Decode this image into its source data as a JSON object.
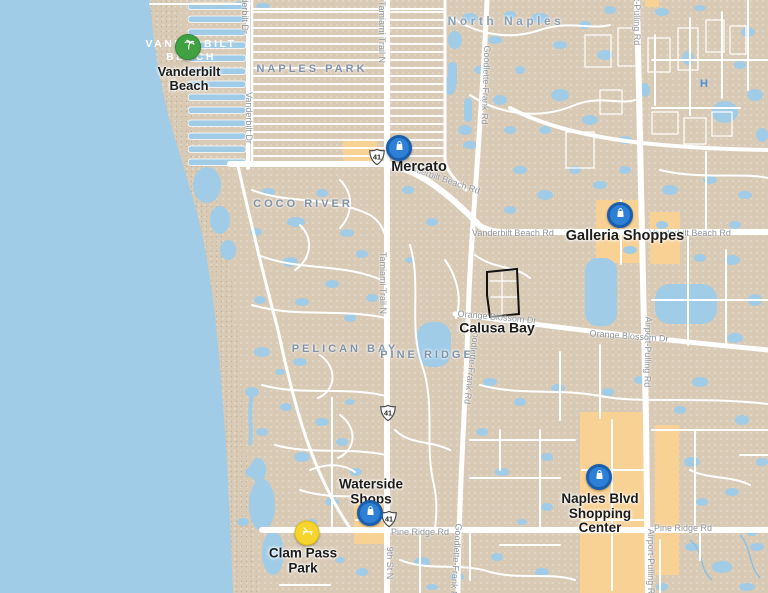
{
  "colors": {
    "water": "#a0cce8",
    "land": "#d9cab5",
    "road": "#ffffff",
    "commercial": "#f8d194",
    "area_label": "#7f92a7",
    "area_label_light": "#ffffff",
    "road_label": "#8f959b",
    "poi_label": "#1c1c1c",
    "marker_green": "#3fa142",
    "marker_blue": "#2e80d6",
    "marker_blue_ring": "#1a5fae",
    "marker_yellow": "#f6d42c",
    "boundary_outline": "#111111",
    "hospital_blue": "#4a90d9"
  },
  "neighborhoods": {
    "vanderbilt_beach": "VANDERBILT BEACH",
    "naples_park": "NAPLES PARK",
    "north_naples": "North Naples",
    "coco_river": "COCO RIVER",
    "pelican_bay": "PELICAN BAY",
    "pine_ridge": "PINE RIDGE"
  },
  "places": {
    "vanderbilt_beach": {
      "label": "Vanderbilt Beach",
      "marker": "palm-tree-green"
    },
    "mercato": {
      "label": "Mercato",
      "marker": "shopping-bag-blue"
    },
    "galleria_shoppes": {
      "label": "Galleria Shoppes",
      "marker": "shopping-bag-blue"
    },
    "calusa_bay": {
      "label": "Calusa Bay",
      "marker": "black-boundary-outline"
    },
    "waterside_shops": {
      "label": "Waterside Shops",
      "marker": "shopping-bag-blue"
    },
    "clam_pass_park": {
      "label": "Clam Pass Park",
      "marker": "beach-chair-yellow"
    },
    "naples_blvd_shopping_center": {
      "label": "Naples Blvd Shopping Center",
      "marker": "shopping-bag-blue"
    }
  },
  "roads": {
    "tamiami_trail_n": "Tamiami Trail N",
    "vanderbilt_dr": "Vanderbilt Dr",
    "goodlette_frank_rd": "Goodlette-Frank Rd",
    "airport_pulling_rd": "Airport-Pulling Rd",
    "vanderbilt_beach_rd": "Vanderbilt Beach Rd",
    "orange_blossom_dr": "Orange Blossom Dr",
    "pine_ridge_rd": "Pine Ridge Rd",
    "ninth_st_n": "9th St N"
  },
  "shield": {
    "route": "41"
  },
  "hospital": "H"
}
